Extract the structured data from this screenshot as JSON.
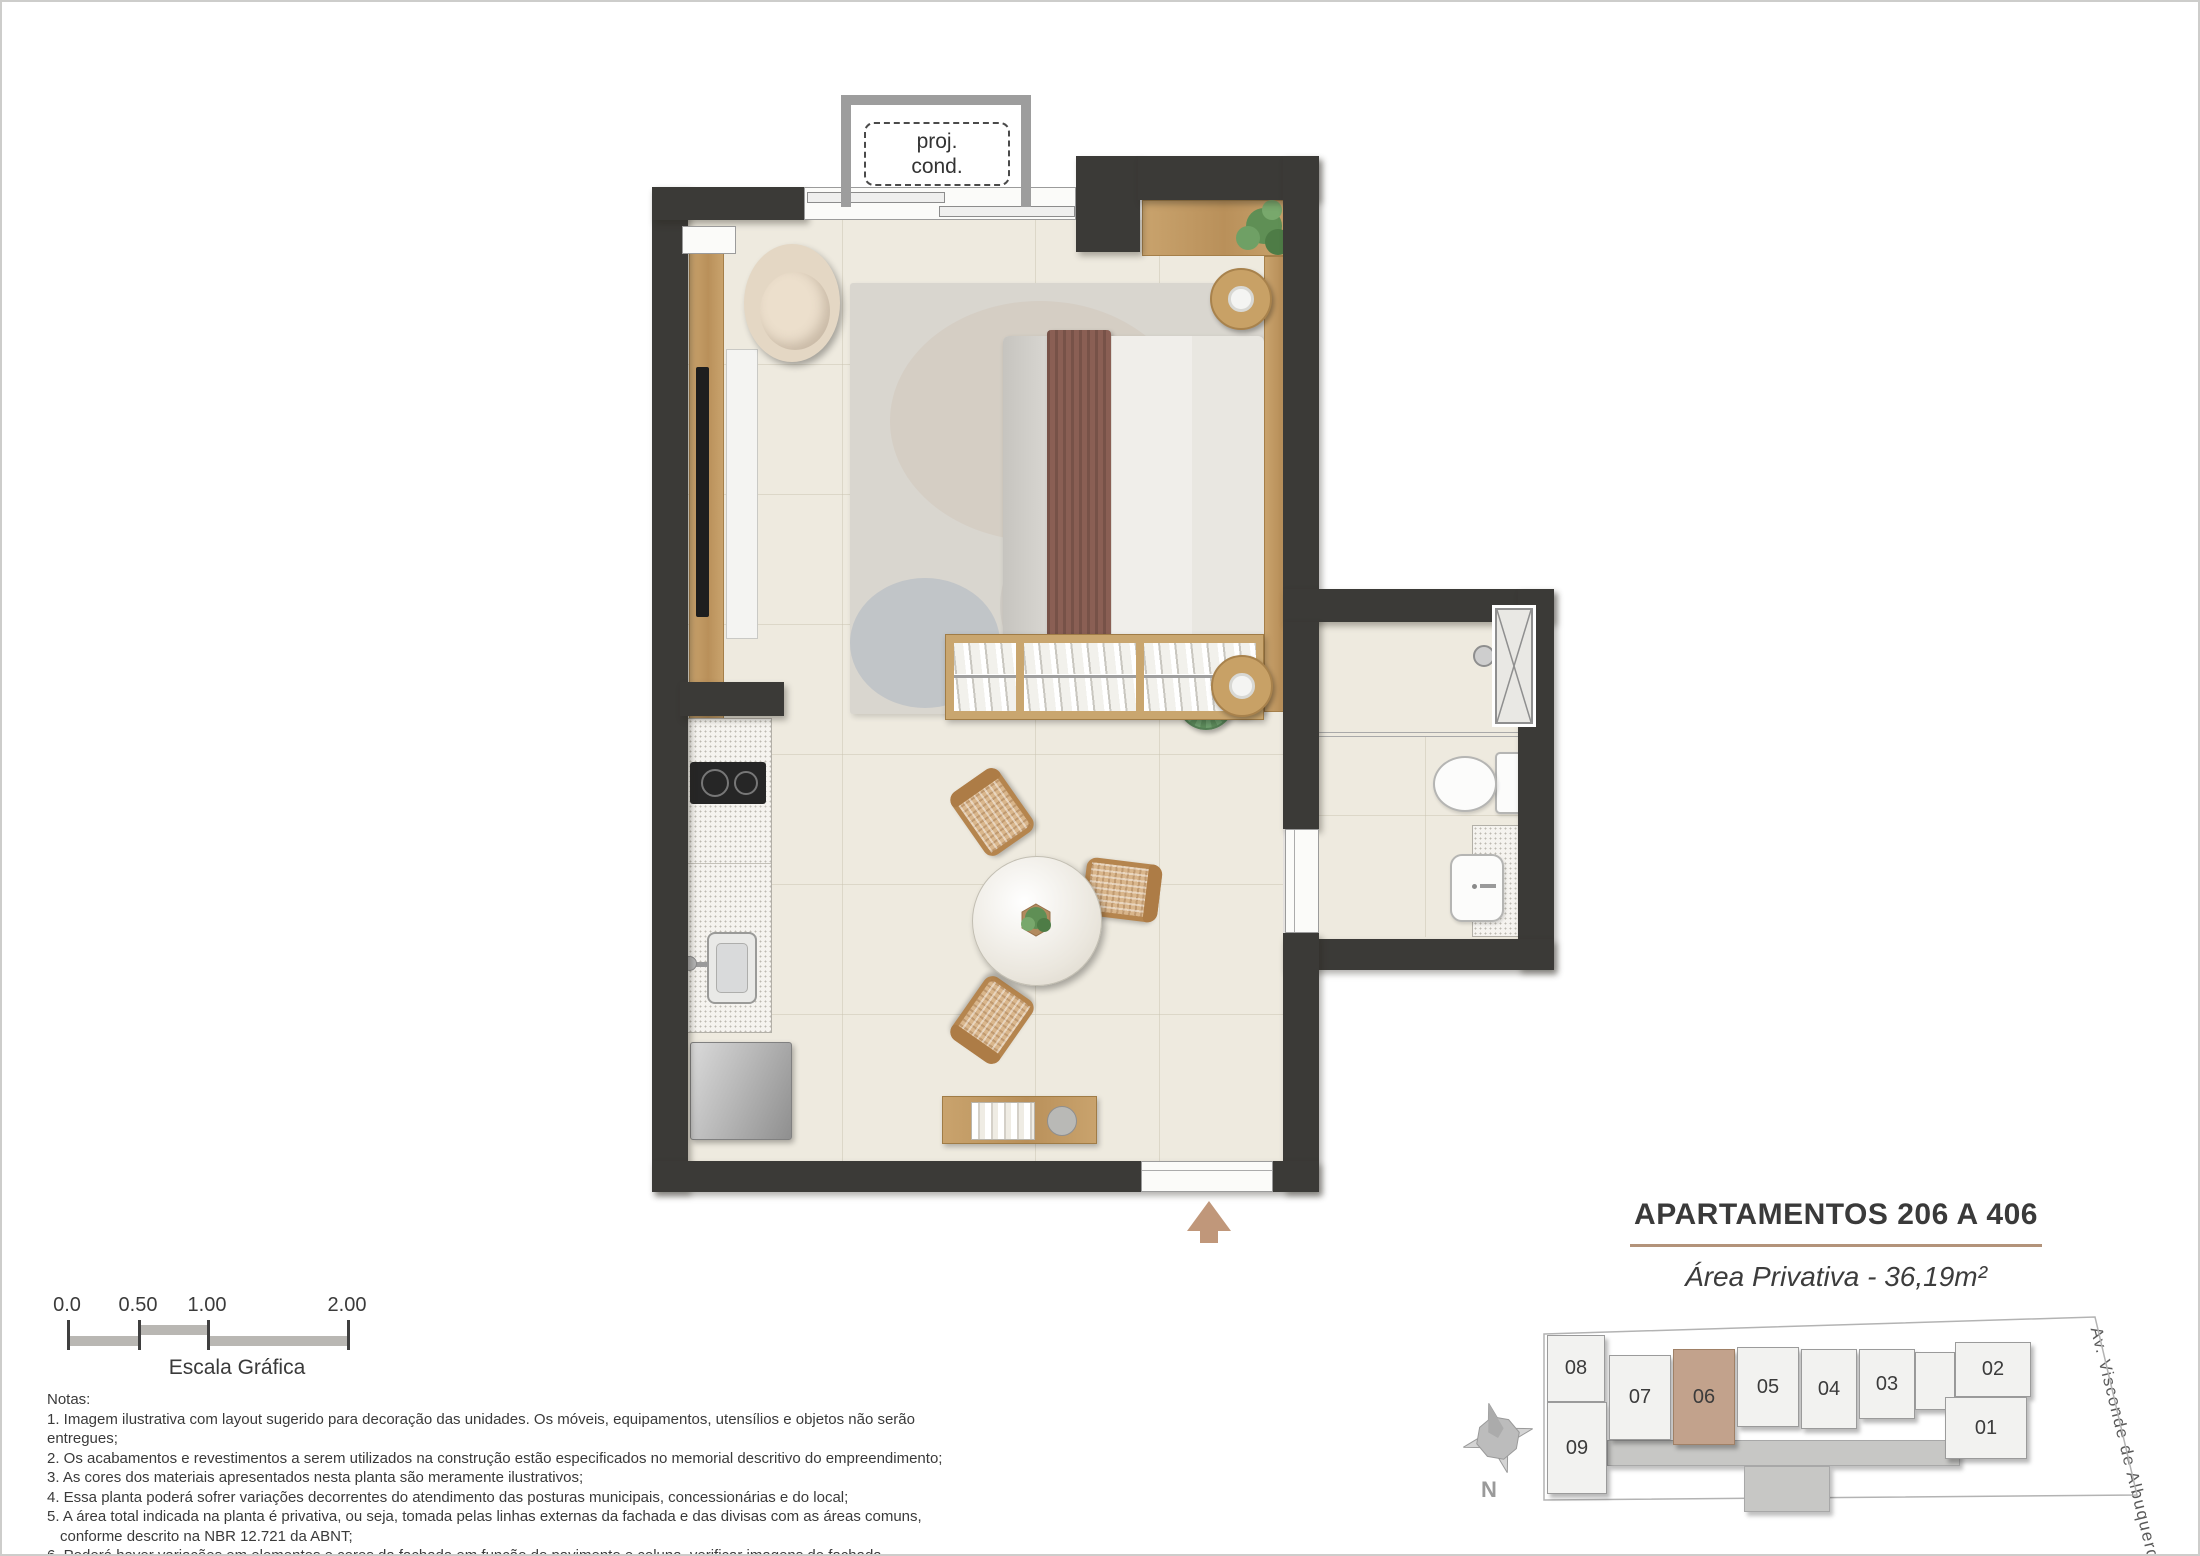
{
  "colors": {
    "wall": "#3b3a37",
    "floor": "#eeeadf",
    "wood": "#c8a26d",
    "highlight_unit": "#c2a28c",
    "title_rule": "#b3937a",
    "entry_arrow": "#c0977a",
    "green_pouf": "#6f9f6e"
  },
  "plan": {
    "balcony_line1": "proj.",
    "balcony_line2": "cond."
  },
  "scale_bar": {
    "labels": [
      "0.0",
      "0.50",
      "1.00",
      "2.00"
    ],
    "caption": "Escala Gráfica"
  },
  "notes": {
    "heading": "Notas:",
    "lines": [
      "1. Imagem ilustrativa com layout sugerido para decoração das unidades. Os móveis, equipamentos, utensílios e objetos não serão entregues;",
      "2. Os acabamentos e revestimentos a serem utilizados na construção estão especificados no memorial descritivo do empreendimento;",
      "3. As cores dos materiais apresentados nesta planta são meramente ilustrativos;",
      "4. Essa planta poderá sofrer variações decorrentes do atendimento das posturas municipais, concessionárias e do local;",
      "5. A área total indicada na planta é privativa, ou seja, tomada pelas linhas externas da fachada e das divisas com as áreas comuns,",
      "conforme descrito na NBR 12.721 da ABNT;",
      "6. Poderá haver variações em elementos e cores da fachada em função do pavimento e coluna, verificar imagens de fachada."
    ]
  },
  "title_block": {
    "title": "APARTAMENTOS 206 A 406",
    "area_label": "Área Privativa - 36,19m²"
  },
  "keyplan": {
    "units": [
      {
        "label": "08"
      },
      {
        "label": "09"
      },
      {
        "label": "07"
      },
      {
        "label": "06",
        "highlighted": true
      },
      {
        "label": "05"
      },
      {
        "label": "04"
      },
      {
        "label": "03"
      },
      {
        "label": "02"
      },
      {
        "label": "01"
      }
    ],
    "compass_label": "N",
    "street_label": "Av. Visconde de Albuquerque"
  }
}
